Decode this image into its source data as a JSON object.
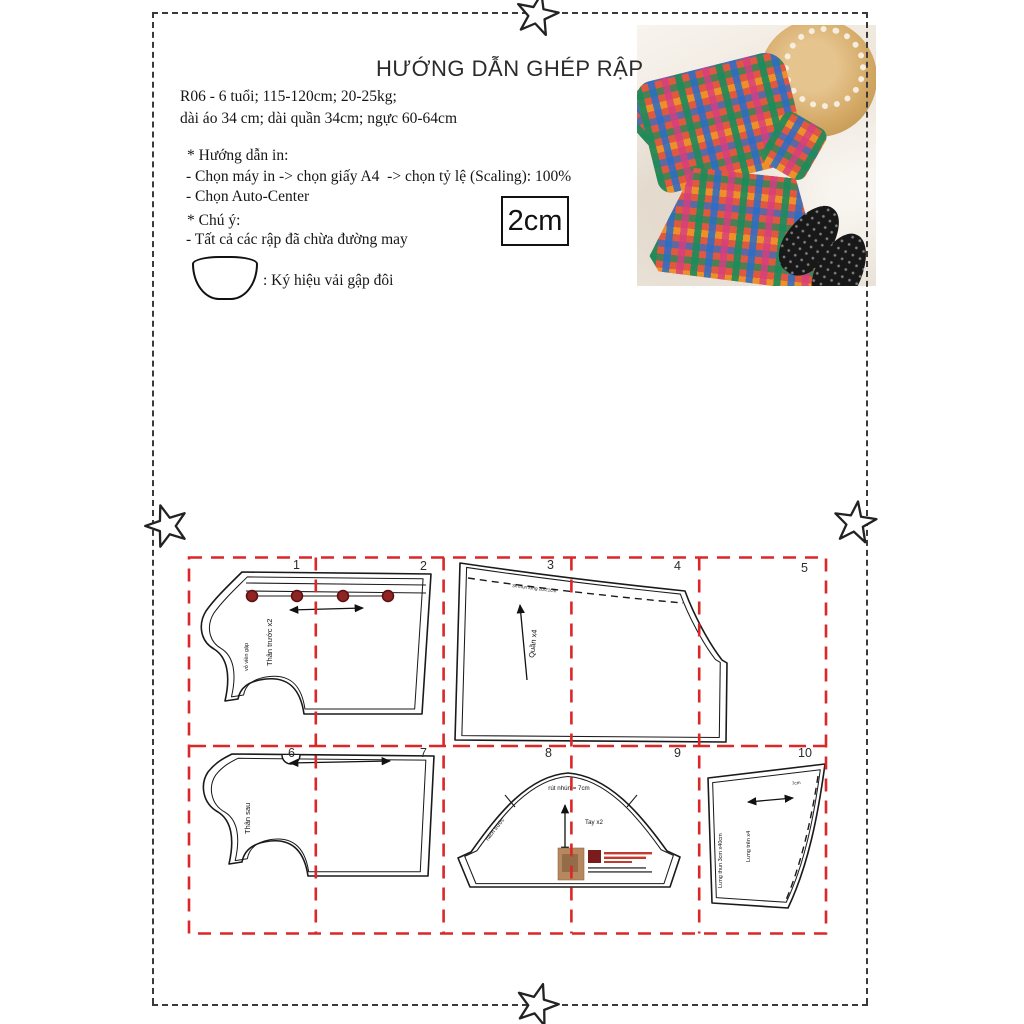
{
  "page": {
    "title": "HƯỚNG DẪN GHÉP RẬP",
    "size_line1": "R06 - 6 tuổi; 115-120cm; 20-25kg;",
    "size_line2": "dài áo 34 cm; dài quần 34cm; ngực 60-64cm",
    "print_heading": "* Hướng dẫn in:",
    "print_step1": "- Chọn máy in -> chọn giấy A4  -> chọn tỷ lệ (Scaling): 100%",
    "print_step2": "- Chọn Auto-Center",
    "note_heading": "* Chú ý:",
    "note_line1": "- Tất cả các rập đã chừa đường may",
    "fold_symbol_caption": ": Ký hiệu vải gập đôi",
    "scale_box_label": "2cm"
  },
  "grid": {
    "line_color": "#db2727",
    "page_numbers": [
      "1",
      "2",
      "3",
      "4",
      "5",
      "6",
      "7",
      "8",
      "9",
      "10"
    ]
  },
  "pieces": {
    "front_bodice": {
      "name_label": "Thân trước x2",
      "edge_label": "vỏ viền gập",
      "button_count": 4,
      "button_color": "#8e2424"
    },
    "pants": {
      "name_label": "Quần x4",
      "waist_note": "3x thun lưng 20/21cm"
    },
    "back_bodice": {
      "name_label": "Thân sau"
    },
    "sleeve": {
      "name_label": "Tay x2",
      "gather_note": "rút nhún = 7cm",
      "armhole_note": "nách trước"
    },
    "waistband": {
      "name_label": "Lưng trên x4",
      "outer_label": "Lưng thun 3cm x40cm",
      "fold_note": "7cm"
    }
  }
}
